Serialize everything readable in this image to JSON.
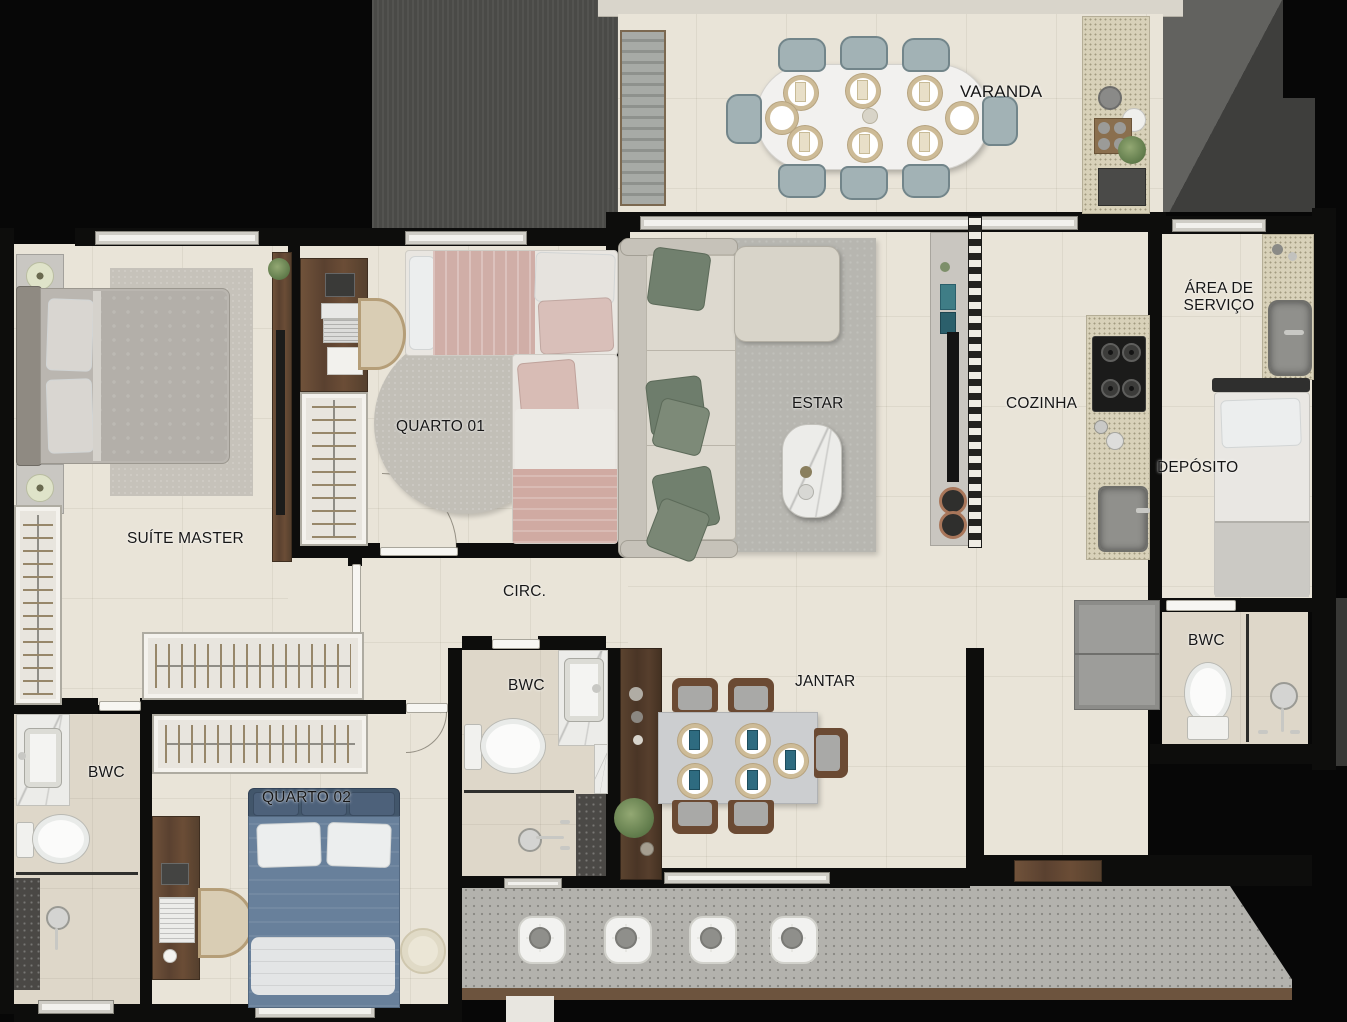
{
  "labels": {
    "varanda": "VARANDA",
    "area_servico": "ÁREA DE SERVIÇO",
    "cozinha": "COZINHA",
    "estar": "ESTAR",
    "deposito": "DEPÓSITO",
    "quarto01": "QUARTO 01",
    "suite_master": "SUÍTE MASTER",
    "circ": "CIRC.",
    "bwc_social": "BWC",
    "bwc_suite": "BWC",
    "bwc_servico": "BWC",
    "jantar": "JANTAR",
    "quarto02": "QUARTO 02"
  },
  "colors": {
    "wall": "#0d0d0c",
    "floor": "#e9e4d8",
    "bath_floor": "#ded7c9",
    "terrazzo": "#b3b2ad",
    "wood": "#6a4c36",
    "granite": "#d8d1b9",
    "marble": "#ecece9",
    "rug_gray": "#b7b6b0",
    "sofa_beige": "#ddd9cf",
    "pillow_green": "#71806e",
    "bed_blue": "#68809b",
    "bed_rose": "#d0aea7",
    "chair_gray_blue": "#a2b2b5",
    "napkin_blue": "#2e6b80",
    "exterior_gray": "#4a4a47"
  }
}
